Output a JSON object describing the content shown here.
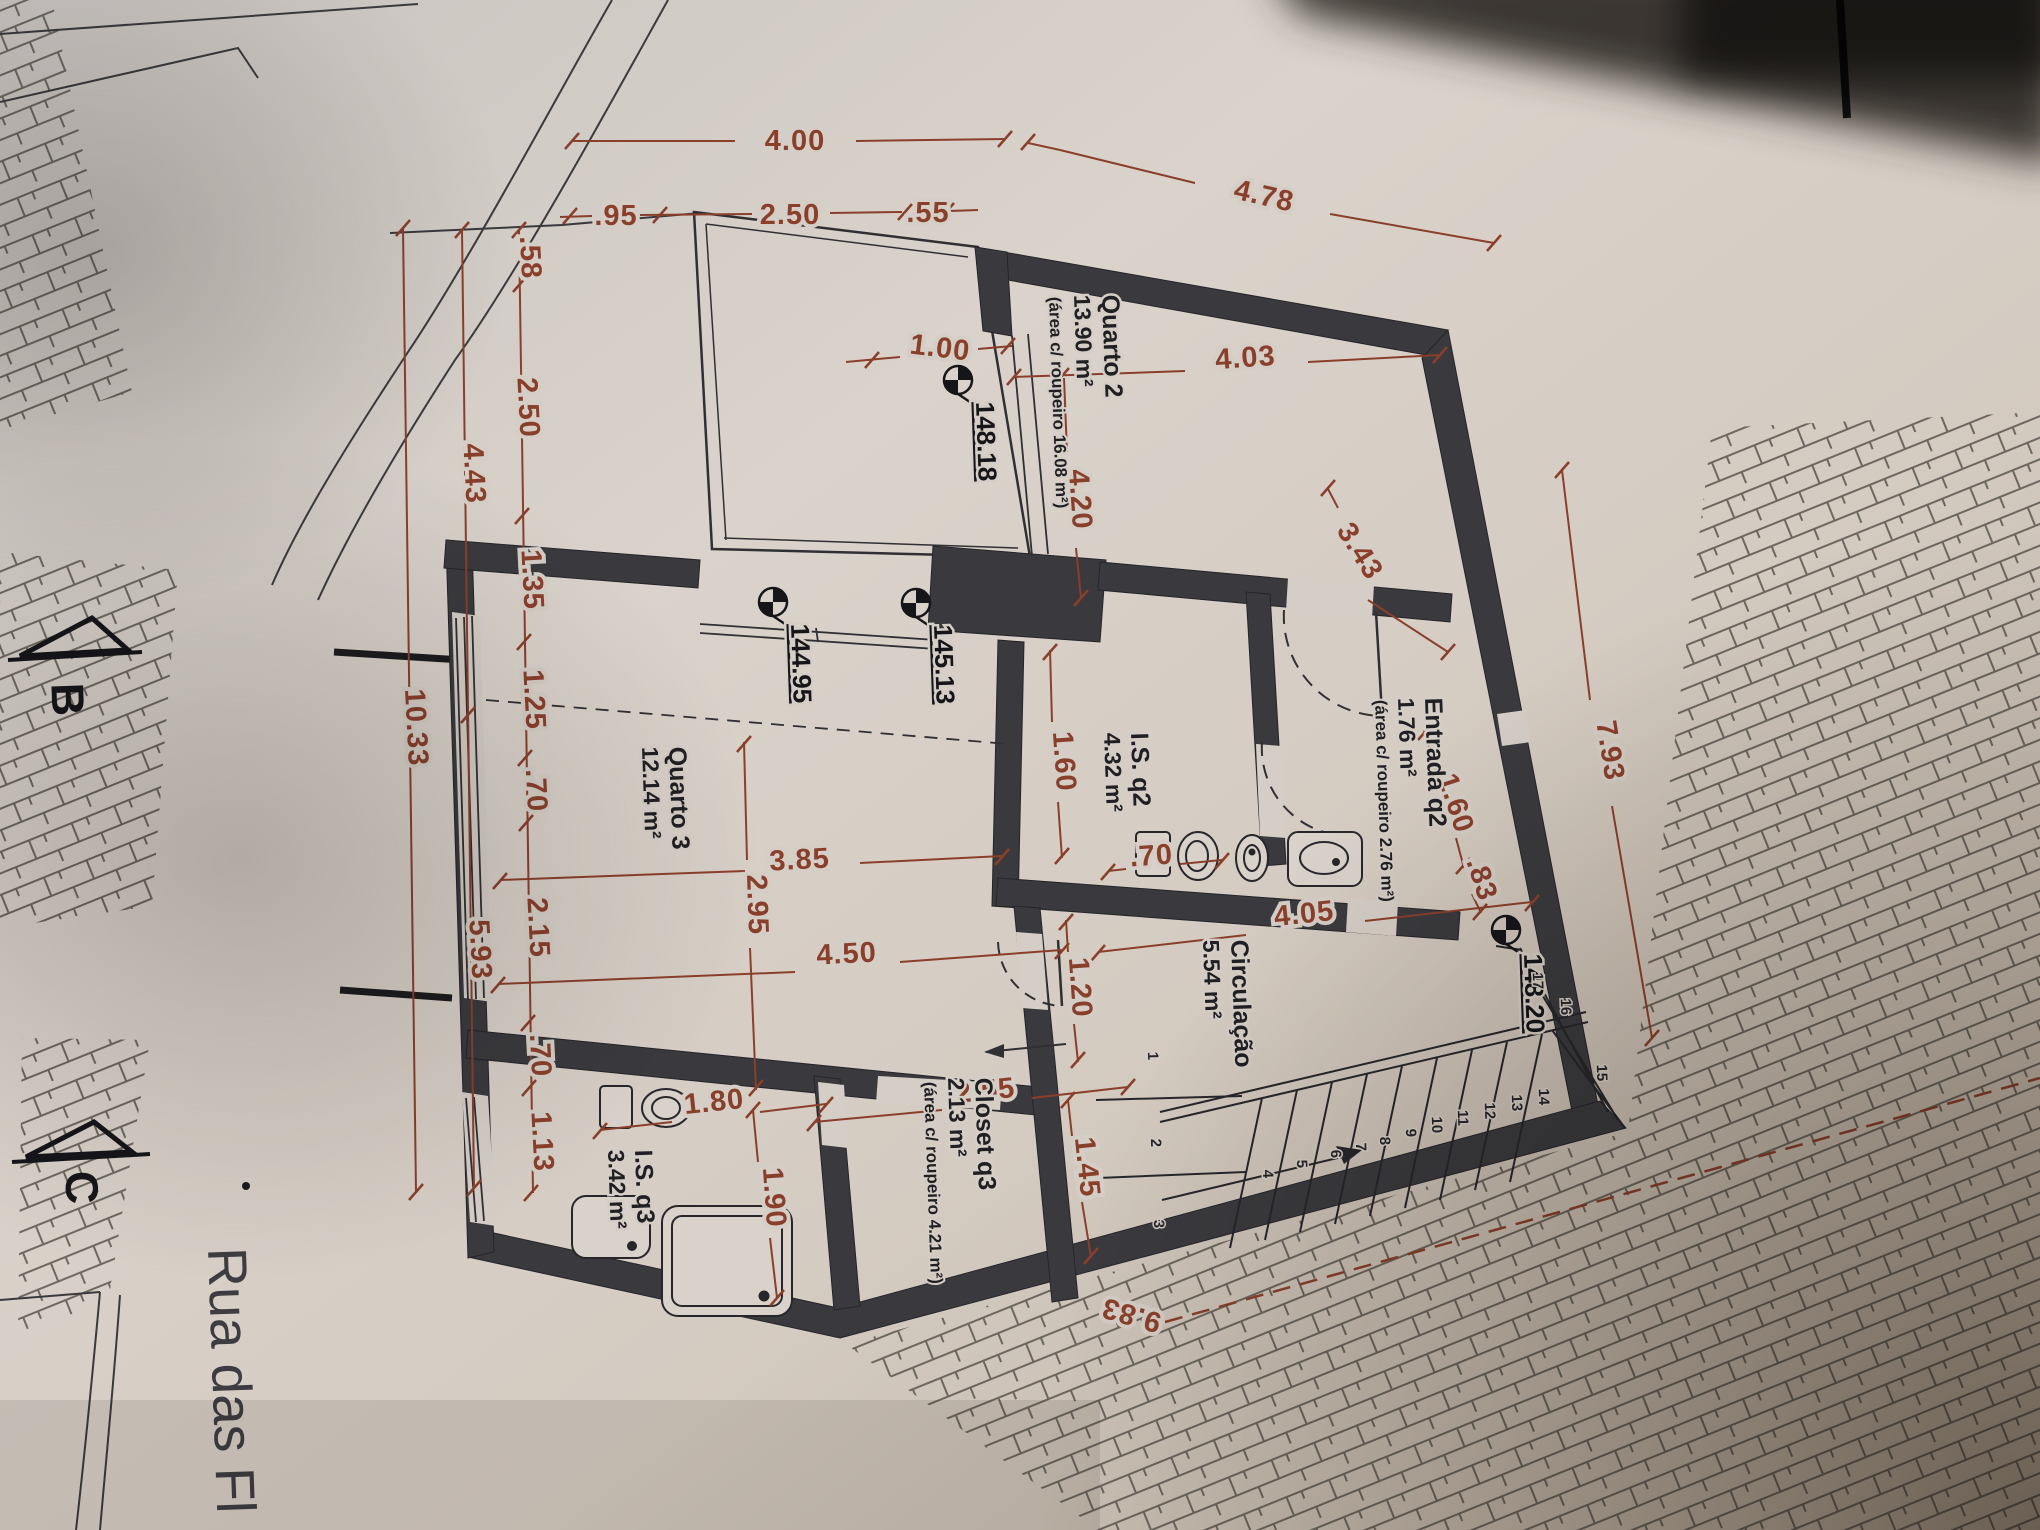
{
  "document": {
    "kind": "architectural floor plan photograph",
    "street_label": "Rua das Fl",
    "section_marks": [
      "B",
      "C"
    ],
    "colors": {
      "paper": "#d5cec6",
      "wall": "#3a3a3e",
      "ink": "#2f2f33",
      "dimension": "#8a3f2b"
    }
  },
  "rooms": {
    "quarto2": {
      "name": "Quarto 2",
      "area": "13.90 m²",
      "note": "(área c/ roupeiro 16.08 m²)"
    },
    "quarto3": {
      "name": "Quarto 3",
      "area": "12.14 m²"
    },
    "is_q2": {
      "name": "I.S. q2",
      "area": "4.32 m²"
    },
    "entrada_q2": {
      "name": "Entrada q2",
      "area": "1.76 m²",
      "note": "(área c/ roupeiro 2.76 m²)"
    },
    "circulacao": {
      "name": "Circulação",
      "area": "5.54 m²"
    },
    "closet_q3": {
      "name": "Closet q3",
      "area": "2.13 m²",
      "note": "(área c/ roupeiro 4.21 m²)"
    },
    "is_q3": {
      "name": "I.S. q3",
      "area": "3.42 m²"
    }
  },
  "levels": [
    "148.18",
    "144.95",
    "145.13",
    "148.20"
  ],
  "dimensions_top": [
    "4.00",
    ".95",
    "2.50",
    ".55",
    "4.78"
  ],
  "dimensions_left": [
    ".58",
    "2.50",
    "1.35",
    "1.25",
    ".70",
    "2.15",
    ".70",
    "1.13",
    "4.43",
    "5.93",
    "10.33"
  ],
  "dimensions_plan": [
    "4.03",
    "1.00",
    "4.20",
    "3.43",
    "1.60",
    ".83",
    "7.93",
    "3.85",
    "2.95",
    "4.50",
    "1.60",
    "1.20",
    ".70",
    "4.05",
    "2.55",
    "1.45",
    "1.80",
    "1.90",
    "9.83"
  ],
  "stair_numbers": [
    "1",
    "2",
    "3",
    "4",
    "5",
    "6",
    "7",
    "8",
    "9",
    "10",
    "11",
    "12",
    "13",
    "14",
    "15",
    "16",
    "17"
  ],
  "texts": [
    {
      "t": "4.00",
      "x": 795,
      "y": 150,
      "r": 0,
      "c": "dim",
      "n": "dim-4-00"
    },
    {
      "t": ".95",
      "x": 616,
      "y": 225,
      "r": 0,
      "c": "dim",
      "n": "dim-0-95"
    },
    {
      "t": "2.50",
      "x": 790,
      "y": 224,
      "r": 0,
      "c": "dim",
      "n": "dim-2-50-top"
    },
    {
      "t": ".55",
      "x": 928,
      "y": 222,
      "r": 0,
      "c": "dim",
      "n": "dim-0-55"
    },
    {
      "t": "4.78",
      "x": 1262,
      "y": 205,
      "r": 13,
      "c": "dim",
      "n": "dim-4-78"
    },
    {
      "t": "4.03",
      "x": 1246,
      "y": 367,
      "r": -4,
      "c": "dim",
      "n": "dim-4-03"
    },
    {
      "t": "1.00",
      "x": 939,
      "y": 357,
      "r": 7,
      "c": "dim",
      "n": "dim-1-00"
    },
    {
      "t": "4.20",
      "x": 1071,
      "y": 500,
      "r": 86,
      "c": "dim",
      "n": "dim-4-20"
    },
    {
      "t": "3.85",
      "x": 800,
      "y": 869,
      "r": -3,
      "c": "dim",
      "n": "dim-3-85"
    },
    {
      "t": "2.95",
      "x": 748,
      "y": 905,
      "r": 88,
      "c": "dim",
      "n": "dim-2-95"
    },
    {
      "t": "4.50",
      "x": 847,
      "y": 963,
      "r": -3,
      "c": "dim",
      "n": "dim-4-50"
    },
    {
      "t": "1.60",
      "x": 1055,
      "y": 762,
      "r": 86,
      "c": "dim",
      "n": "dim-1-60-isq2"
    },
    {
      "t": "1.20",
      "x": 1071,
      "y": 988,
      "r": 86,
      "c": "dim",
      "n": "dim-1-20"
    },
    {
      "t": ".70",
      "x": 1152,
      "y": 865,
      "r": -4,
      "c": "dim",
      "n": "dim-0-70-wc"
    },
    {
      "t": "4.05",
      "x": 1305,
      "y": 923,
      "r": -6,
      "c": "dim",
      "n": "dim-4-05"
    },
    {
      "t": "1.60",
      "x": 1447,
      "y": 806,
      "r": 72,
      "c": "dim",
      "n": "dim-1-60-entrada"
    },
    {
      "t": ".83",
      "x": 1473,
      "y": 882,
      "r": 72,
      "c": "dim",
      "n": "dim-0-83"
    },
    {
      "t": "3.43",
      "x": 1352,
      "y": 556,
      "r": 58,
      "c": "dim",
      "n": "dim-3-43"
    },
    {
      "t": "7.93",
      "x": 1601,
      "y": 752,
      "r": 81,
      "c": "dim",
      "n": "dim-7-93"
    },
    {
      "t": "2.55",
      "x": 986,
      "y": 1100,
      "r": -6,
      "c": "dim",
      "n": "dim-2-55"
    },
    {
      "t": "1.45",
      "x": 1078,
      "y": 1168,
      "r": 84,
      "c": "dim",
      "n": "dim-1-45"
    },
    {
      "t": "1.80",
      "x": 715,
      "y": 1111,
      "r": -6,
      "c": "dim",
      "n": "dim-1-80"
    },
    {
      "t": "1.90",
      "x": 765,
      "y": 1198,
      "r": 86,
      "c": "dim",
      "n": "dim-1-90"
    },
    {
      "t": ".58",
      "x": 521,
      "y": 258,
      "r": 87,
      "c": "dim",
      "n": "dim-0-58"
    },
    {
      "t": "2.50",
      "x": 519,
      "y": 408,
      "r": 87,
      "c": "dim",
      "n": "dim-2-50-left"
    },
    {
      "t": "1.35",
      "x": 523,
      "y": 580,
      "r": 87,
      "c": "dim",
      "n": "dim-1-35"
    },
    {
      "t": "1.25",
      "x": 525,
      "y": 700,
      "r": 87,
      "c": "dim",
      "n": "dim-1-25"
    },
    {
      "t": ".70",
      "x": 527,
      "y": 791,
      "r": 87,
      "c": "dim",
      "n": "dim-0-70-left1"
    },
    {
      "t": "2.15",
      "x": 529,
      "y": 928,
      "r": 87,
      "c": "dim",
      "n": "dim-2-15"
    },
    {
      "t": ".70",
      "x": 531,
      "y": 1056,
      "r": 87,
      "c": "dim",
      "n": "dim-0-70-left2"
    },
    {
      "t": "1.13",
      "x": 533,
      "y": 1142,
      "r": 87,
      "c": "dim",
      "n": "dim-1-13"
    },
    {
      "t": "4.43",
      "x": 465,
      "y": 474,
      "r": 87,
      "c": "dim",
      "n": "dim-4-43"
    },
    {
      "t": "5.93",
      "x": 471,
      "y": 950,
      "r": 87,
      "c": "dim",
      "n": "dim-5-93"
    },
    {
      "t": "10.33",
      "x": 407,
      "y": 728,
      "r": 87,
      "c": "dim",
      "n": "dim-10-33"
    },
    {
      "t": "9.83",
      "x": 1134,
      "y": 1306,
      "r": 196,
      "c": "dim",
      "n": "dim-9-83"
    },
    {
      "t": "148.18",
      "x": 976,
      "y": 402,
      "r": 88,
      "c": "lvl",
      "a": "s",
      "u": 1,
      "n": "level-148-18"
    },
    {
      "t": "144.95",
      "x": 791,
      "y": 624,
      "r": 88,
      "c": "lvl",
      "a": "s",
      "u": 1,
      "n": "level-144-95"
    },
    {
      "t": "145.13",
      "x": 934,
      "y": 625,
      "r": 88,
      "c": "lvl",
      "a": "s",
      "u": 1,
      "n": "level-145-13"
    },
    {
      "t": "148.20",
      "x": 1524,
      "y": 954,
      "r": 88,
      "c": "lvl",
      "a": "s",
      "u": 1,
      "n": "level-148-20"
    },
    {
      "t": "Quarto 2",
      "x": 1102,
      "y": 295,
      "r": 88,
      "c": "lbl",
      "a": "s",
      "n": "room-label-quarto2"
    },
    {
      "t": "13.90 m²",
      "x": 1074,
      "y": 295,
      "r": 88,
      "c": "lbla",
      "a": "s",
      "n": "room-area-quarto2"
    },
    {
      "t": "(área c/ roupeiro 16.08 m²)",
      "x": 1049,
      "y": 297,
      "r": 88,
      "c": "lbls",
      "a": "s",
      "n": "room-note-quarto2"
    },
    {
      "t": "Quarto 3",
      "x": 669,
      "y": 747,
      "r": 88,
      "c": "lbl",
      "a": "s",
      "n": "room-label-quarto3"
    },
    {
      "t": "12.14 m²",
      "x": 642,
      "y": 747,
      "r": 88,
      "c": "lbla",
      "a": "s",
      "n": "room-area-quarto3"
    },
    {
      "t": "I.S. q2",
      "x": 1131,
      "y": 733,
      "r": 88,
      "c": "lbl",
      "a": "s",
      "n": "room-label-is-q2"
    },
    {
      "t": "4.32 m²",
      "x": 1104,
      "y": 733,
      "r": 88,
      "c": "lbla",
      "a": "s",
      "n": "room-area-is-q2"
    },
    {
      "t": "Entrada q2",
      "x": 1425,
      "y": 698,
      "r": 88,
      "c": "lbl",
      "a": "s",
      "n": "room-label-entrada-q2"
    },
    {
      "t": "1.76 m²",
      "x": 1398,
      "y": 698,
      "r": 88,
      "c": "lbla",
      "a": "s",
      "n": "room-area-entrada-q2"
    },
    {
      "t": "(área c/ roupeiro 2.76 m²)",
      "x": 1375,
      "y": 700,
      "r": 88,
      "c": "lbls",
      "a": "s",
      "n": "room-note-entrada-q2"
    },
    {
      "t": "Circulação",
      "x": 1231,
      "y": 940,
      "r": 88,
      "c": "lbl",
      "a": "s",
      "n": "room-label-circulacao"
    },
    {
      "t": "5.54 m²",
      "x": 1203,
      "y": 940,
      "r": 88,
      "c": "lbla",
      "a": "s",
      "n": "room-area-circulacao"
    },
    {
      "t": "Closet q3",
      "x": 975,
      "y": 1078,
      "r": 88,
      "c": "lbl",
      "a": "s",
      "n": "room-label-closet-q3"
    },
    {
      "t": "2.13 m²",
      "x": 948,
      "y": 1078,
      "r": 88,
      "c": "lbla",
      "a": "s",
      "n": "room-area-closet-q3"
    },
    {
      "t": "(área c/ roupeiro 4.21 m²)",
      "x": 924,
      "y": 1082,
      "r": 88,
      "c": "lbls",
      "a": "s",
      "n": "room-note-closet-q3"
    },
    {
      "t": "I.S. q3",
      "x": 635,
      "y": 1150,
      "r": 88,
      "c": "lbl",
      "a": "s",
      "n": "room-label-is-q3"
    },
    {
      "t": "3.42 m²",
      "x": 608,
      "y": 1150,
      "r": 88,
      "c": "lbla",
      "a": "s",
      "n": "room-area-is-q3"
    },
    {
      "t": "Rua das Fl",
      "x": 208,
      "y": 1248,
      "r": 88,
      "c": "rua",
      "a": "s",
      "n": "street-label"
    },
    {
      "t": "B",
      "x": 52,
      "y": 700,
      "r": 88,
      "c": "sec",
      "n": "section-mark-b"
    },
    {
      "t": "C",
      "x": 66,
      "y": 1188,
      "r": 88,
      "c": "sec",
      "n": "section-mark-c"
    },
    {
      "t": "1",
      "x": 1148,
      "y": 1056,
      "r": 88,
      "c": "stn",
      "n": "stair-number"
    },
    {
      "t": "2",
      "x": 1151,
      "y": 1143,
      "r": 88,
      "c": "stn",
      "n": "stair-number"
    },
    {
      "t": "3",
      "x": 1154,
      "y": 1224,
      "r": 88,
      "c": "stn",
      "n": "stair-number"
    },
    {
      "t": "4",
      "x": 1263,
      "y": 1174,
      "r": 88,
      "c": "stn",
      "n": "stair-number"
    },
    {
      "t": "5",
      "x": 1297,
      "y": 1164,
      "r": 88,
      "c": "stn",
      "n": "stair-number"
    },
    {
      "t": "6",
      "x": 1331,
      "y": 1154,
      "r": 88,
      "c": "stn",
      "n": "stair-number"
    },
    {
      "t": "7",
      "x": 1356,
      "y": 1147,
      "r": 88,
      "c": "stn",
      "n": "stair-number"
    },
    {
      "t": "8",
      "x": 1380,
      "y": 1141,
      "r": 88,
      "c": "stn",
      "n": "stair-number"
    },
    {
      "t": "9",
      "x": 1406,
      "y": 1133,
      "r": 88,
      "c": "stn",
      "n": "stair-number"
    },
    {
      "t": "10",
      "x": 1432,
      "y": 1125,
      "r": 88,
      "c": "stn",
      "n": "stair-number"
    },
    {
      "t": "11",
      "x": 1458,
      "y": 1118,
      "r": 88,
      "c": "stn",
      "n": "stair-number"
    },
    {
      "t": "12",
      "x": 1485,
      "y": 1111,
      "r": 88,
      "c": "stn",
      "n": "stair-number"
    },
    {
      "t": "13",
      "x": 1512,
      "y": 1103,
      "r": 88,
      "c": "stn",
      "n": "stair-number"
    },
    {
      "t": "14",
      "x": 1539,
      "y": 1097,
      "r": 88,
      "c": "stn",
      "n": "stair-number"
    },
    {
      "t": "15",
      "x": 1597,
      "y": 1073,
      "r": 88,
      "c": "stn",
      "n": "stair-number"
    },
    {
      "t": "16",
      "x": 1561,
      "y": 1007,
      "r": 88,
      "c": "stn",
      "n": "stair-number"
    },
    {
      "t": "17",
      "x": 1533,
      "y": 981,
      "r": 88,
      "c": "stn",
      "n": "stair-number"
    }
  ]
}
